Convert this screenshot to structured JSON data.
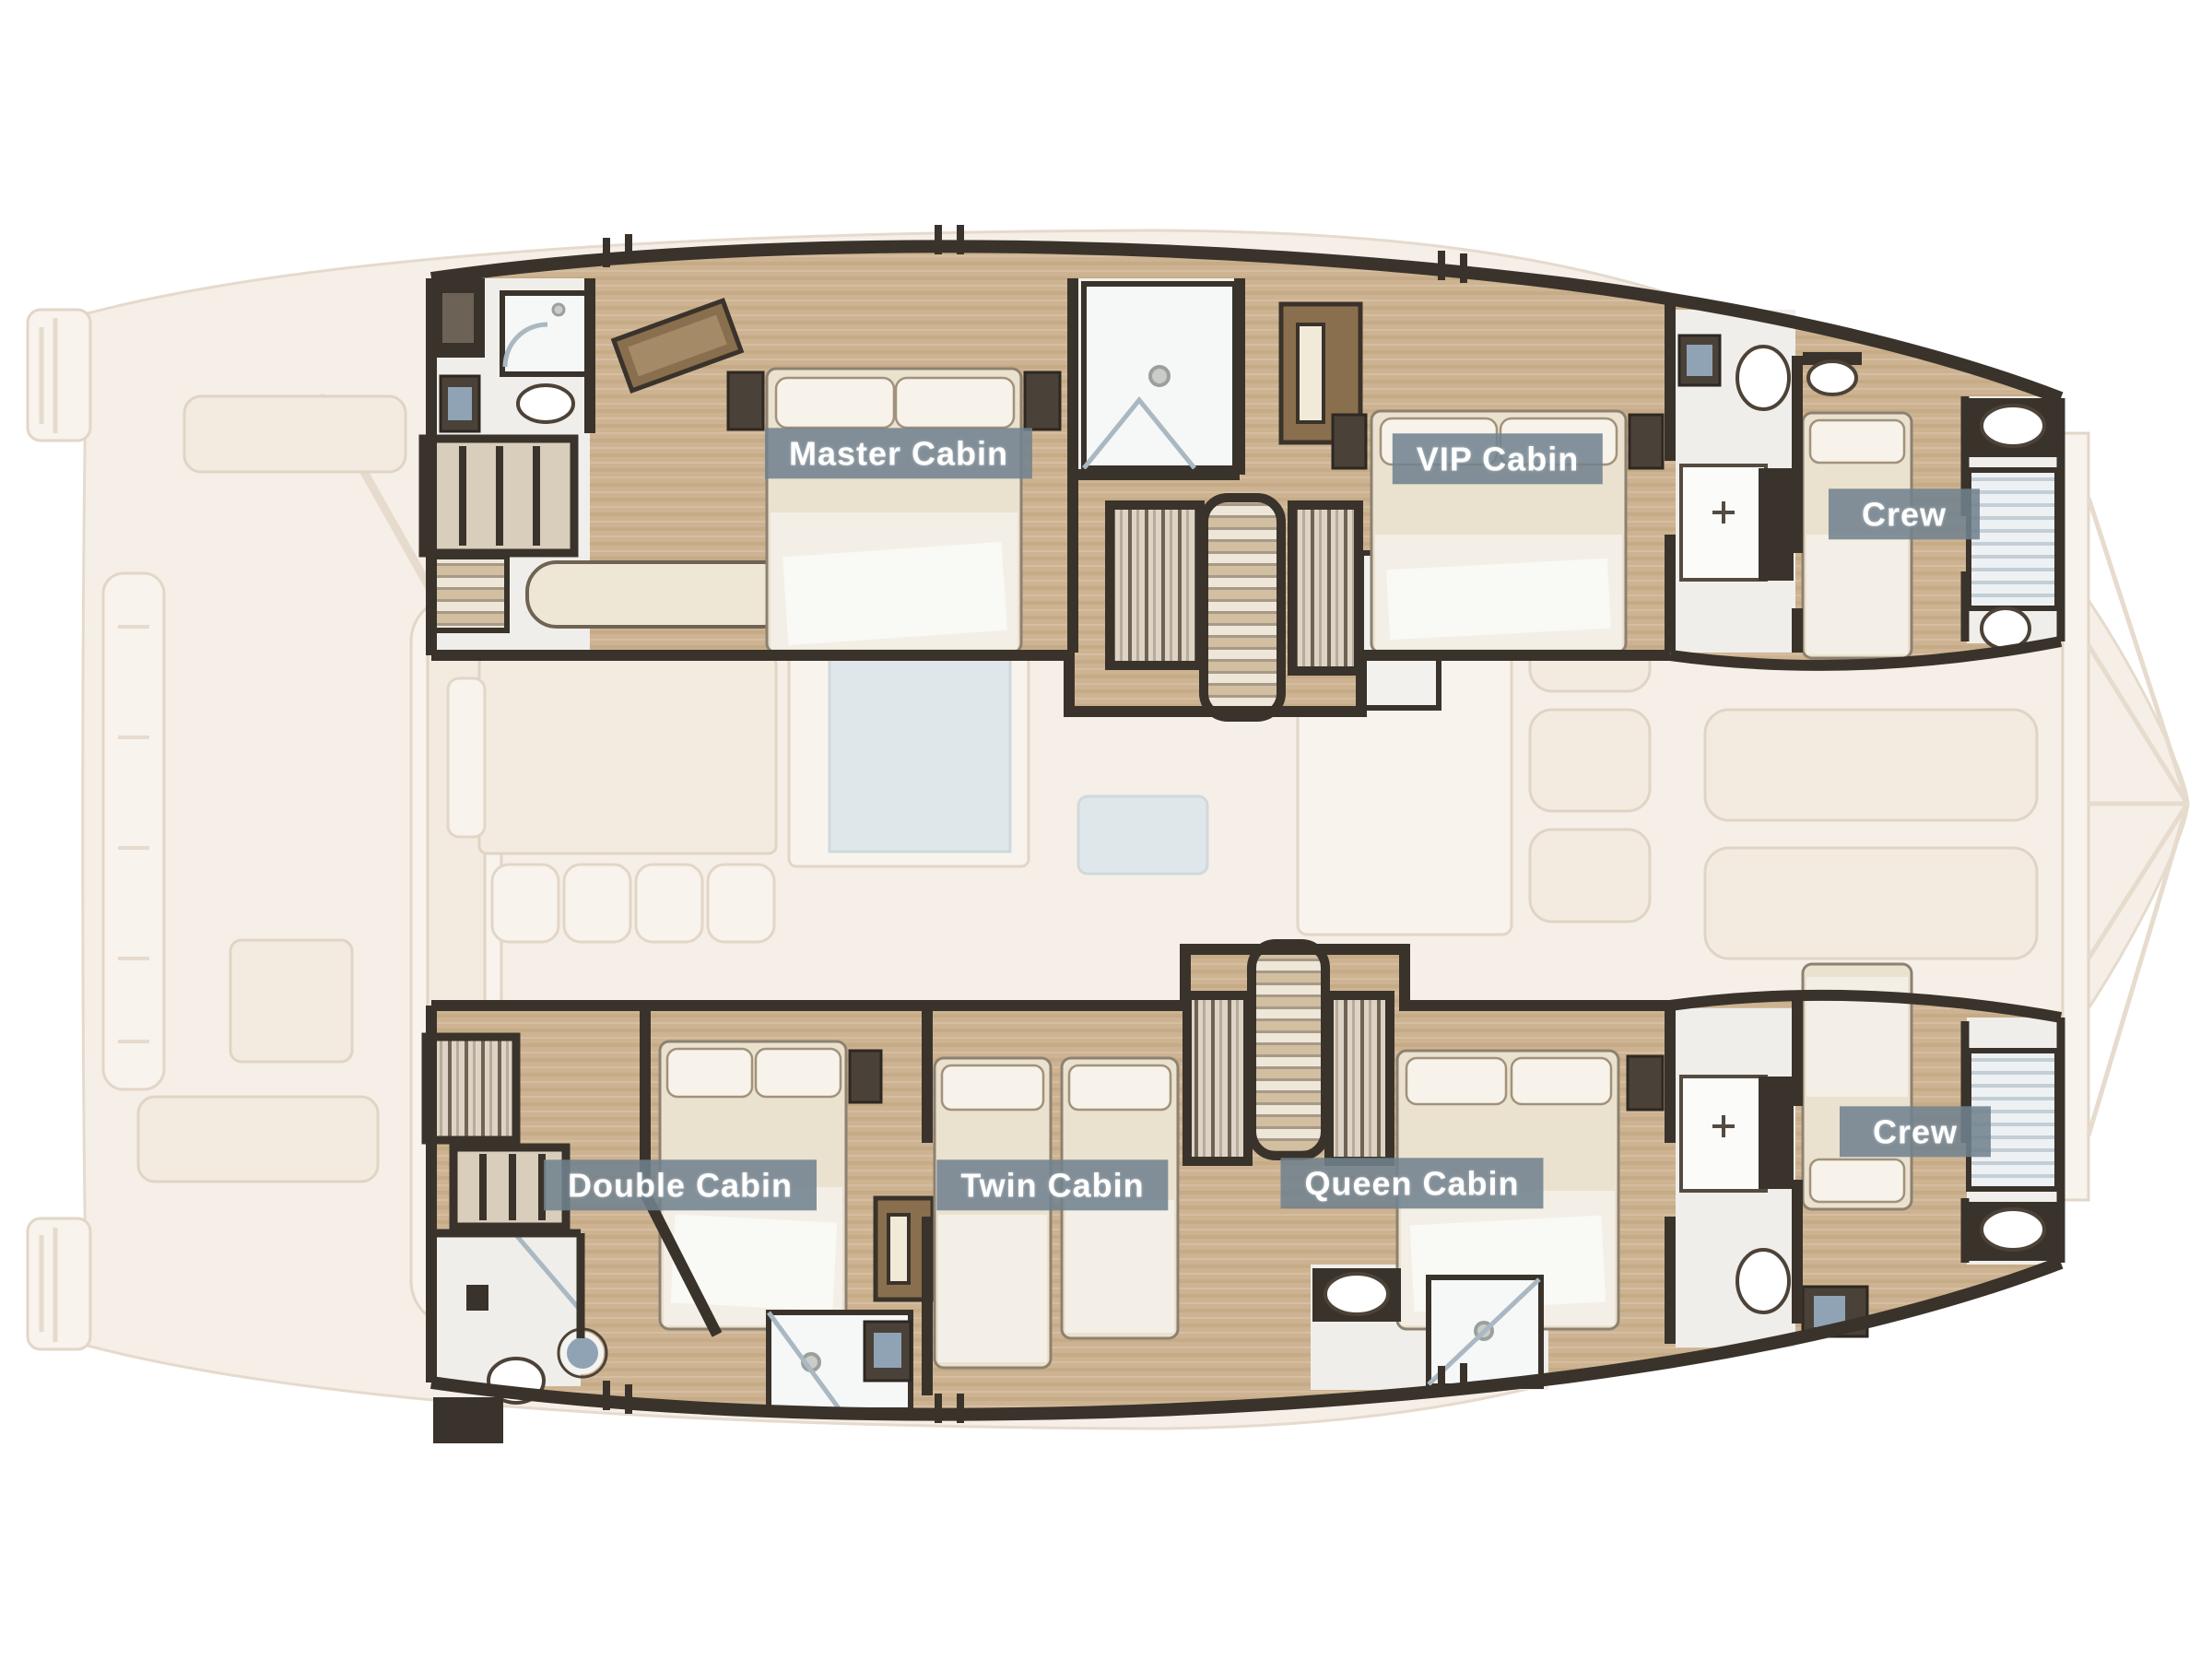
{
  "cabins": [
    {
      "id": "master-cabin",
      "label": "Master Cabin"
    },
    {
      "id": "vip-cabin",
      "label": "VIP Cabin"
    },
    {
      "id": "crew-cabin-forward-port",
      "label": "Crew"
    },
    {
      "id": "double-cabin",
      "label": "Double Cabin"
    },
    {
      "id": "twin-cabin",
      "label": "Twin Cabin"
    },
    {
      "id": "queen-cabin",
      "label": "Queen Cabin"
    },
    {
      "id": "crew-cabin-forward-starboard",
      "label": "Crew"
    }
  ],
  "colors": {
    "label_bg": "#71828f",
    "label_text": "#ffffff",
    "wall": "#3a332b",
    "floor_wood": "#cdb392",
    "furniture_cream": "#eae1cf",
    "faded_deck": "#f6efe7",
    "bath_floor": "#f0eeea",
    "glass_blue": "#a9b8c2",
    "accent_blue": "#8fa3b5"
  }
}
